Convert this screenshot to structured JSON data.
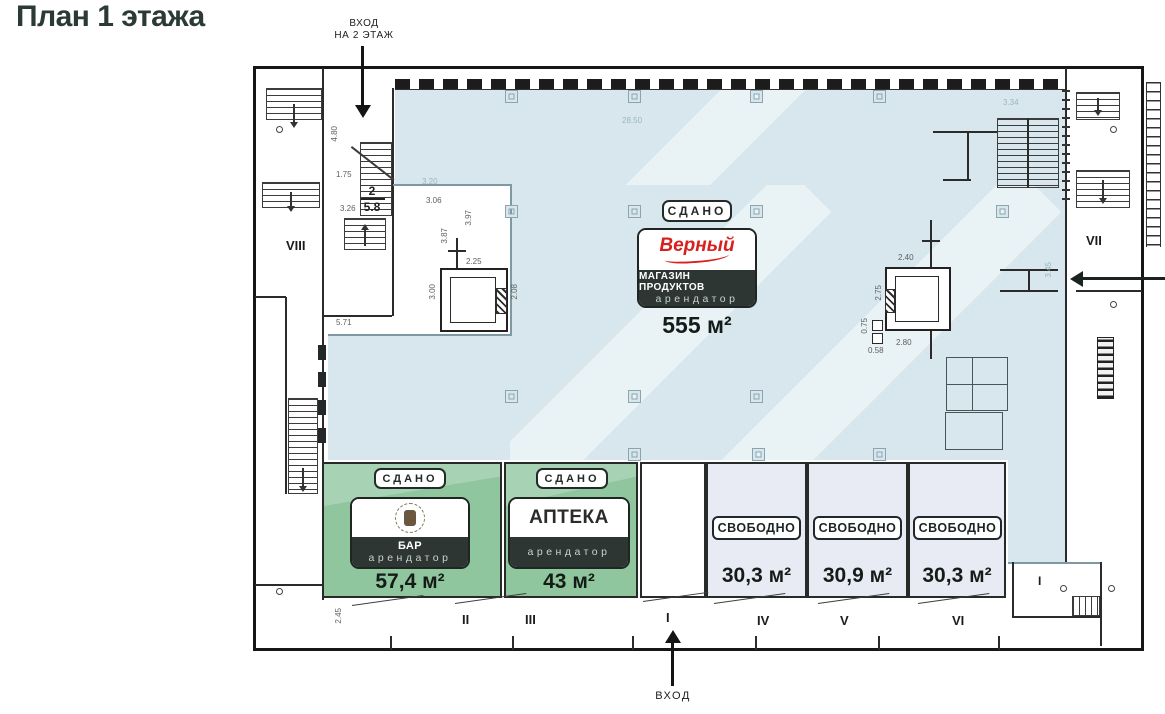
{
  "title": "План 1 этажа",
  "labels": {
    "entrance2_l1": "ВХОД",
    "entrance2_l2": "НА 2 ЭТАЖ",
    "entrance": "ВХОД"
  },
  "units": {
    "grocery": {
      "status": "СДАНО",
      "brand": "Верный",
      "category": "МАГАЗИН ПРОДУКТОВ",
      "role": "арендатор",
      "area": "555 м²"
    },
    "bar": {
      "status": "СДАНО",
      "name": "БАР",
      "role": "арендатор",
      "area": "57,4 м²"
    },
    "pharmacy": {
      "status": "СДАНО",
      "name": "АПТЕКА",
      "role": "арендатор",
      "area": "43 м²"
    },
    "vacant": [
      {
        "status": "СВОБОДНО",
        "area": "30,3 м²"
      },
      {
        "status": "СВОБОДНО",
        "area": "30,9 м²"
      },
      {
        "status": "СВОБОДНО",
        "area": "30,3 м²"
      }
    ]
  },
  "sections": {
    "i": "I",
    "ii": "II",
    "iii": "III",
    "iv": "IV",
    "v": "V",
    "vi": "VI",
    "vii": "VII",
    "viii": "VIII",
    "i_right": "I"
  },
  "room2": {
    "number": "2",
    "area": "5.8"
  },
  "dimensions": {
    "d480": "4.80",
    "d175": "1.75",
    "d326": "3.26",
    "d306": "3.06",
    "d387": "3.87",
    "d397": "3.97",
    "d571": "5.71",
    "d2850": "28.50",
    "d320": "3.20",
    "d300": "3.00",
    "d225": "2.25",
    "d208": "2.08",
    "d240": "2.40",
    "d275": "2.75",
    "d280": "2.80",
    "d075": "0.75",
    "d058": "0.58",
    "d334": "3.34",
    "d345": "3.45",
    "d245": "2.45"
  },
  "colors": {
    "title": "#2c3a34",
    "rented_main": "#d7e7ed",
    "rented_small": "#8fc69e",
    "vacant": "#e9ebf4",
    "card_dark": "#2d3632",
    "brand_red": "#d8201d"
  }
}
